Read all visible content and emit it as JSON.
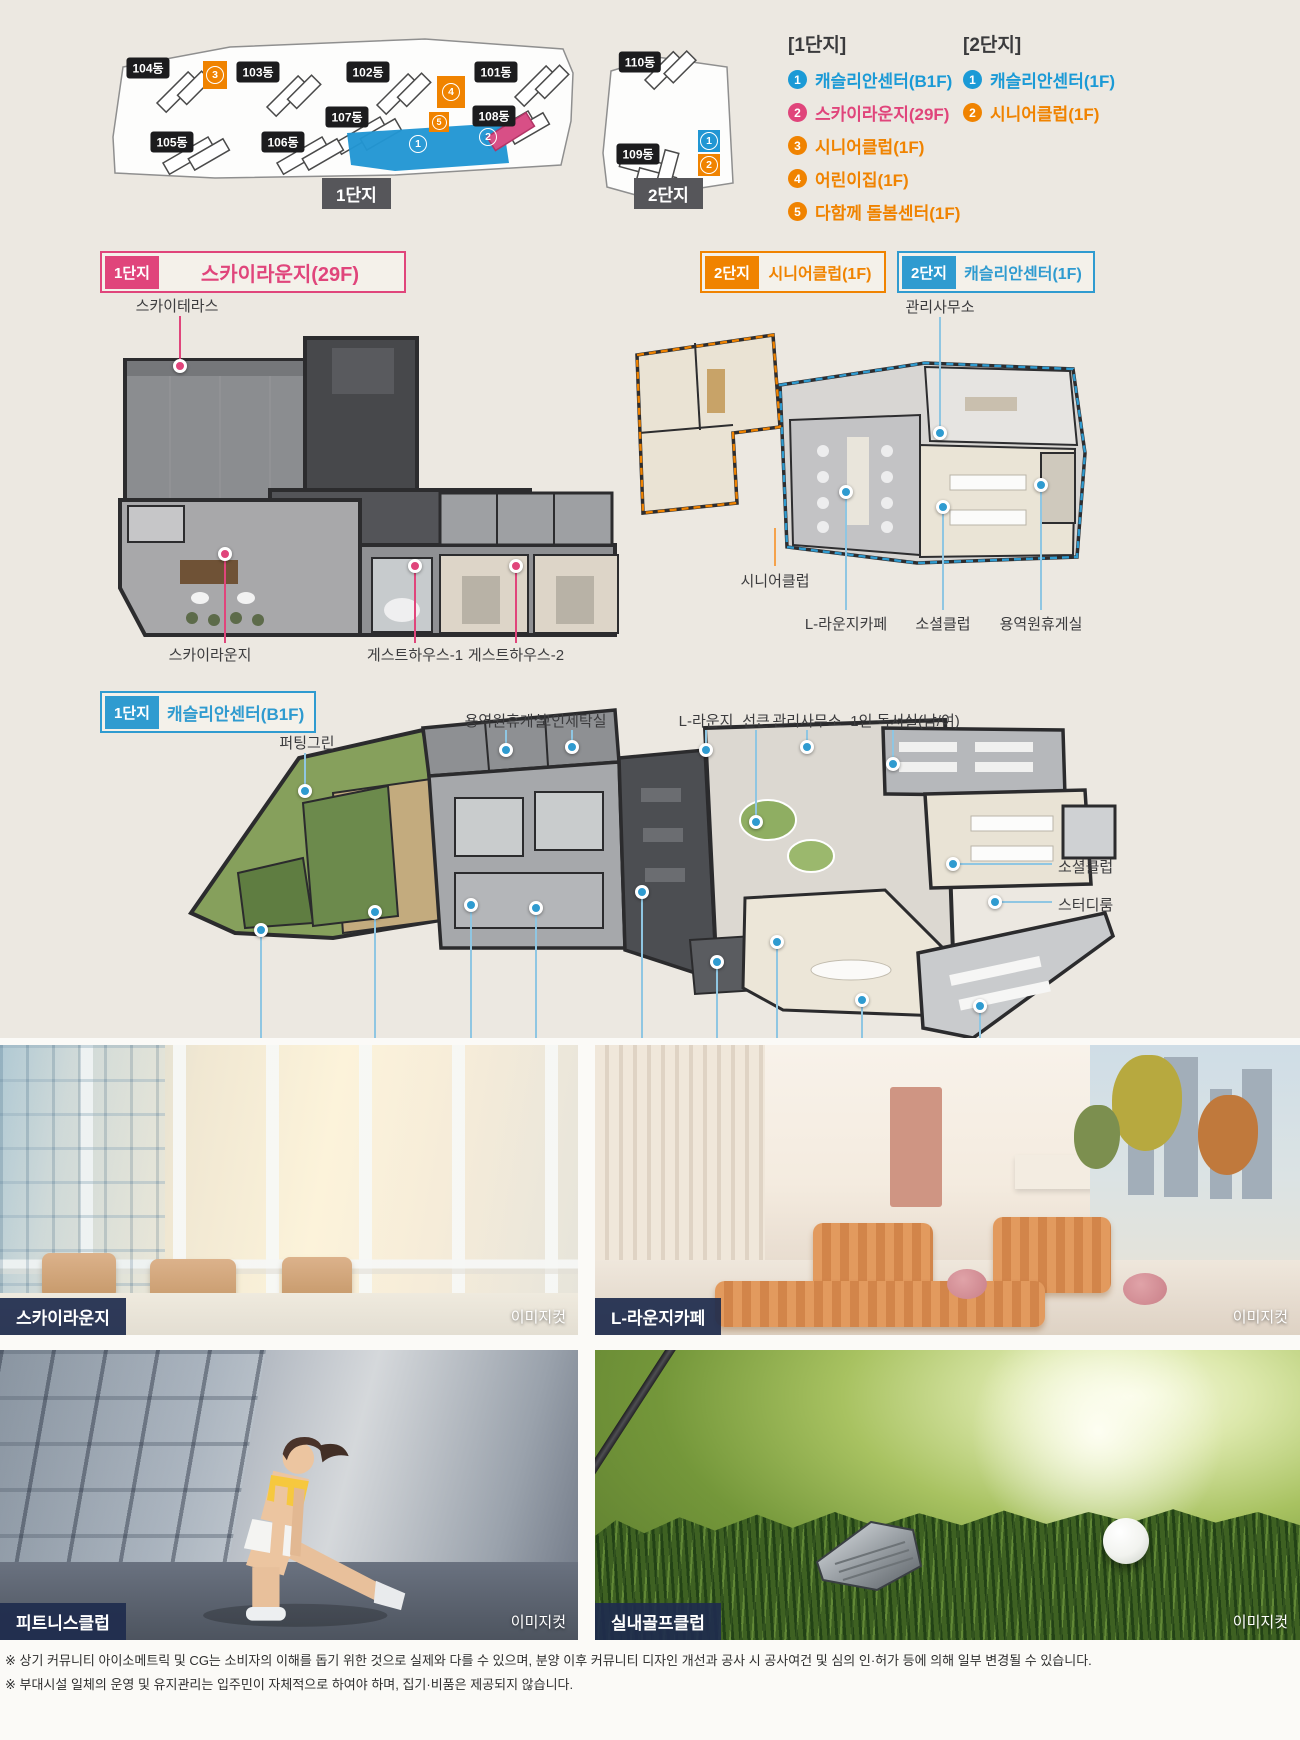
{
  "site": {
    "complex1": {
      "name": "1단지",
      "buildings": [
        {
          "label": "104동"
        },
        {
          "label": "103동"
        },
        {
          "label": "102동"
        },
        {
          "label": "101동"
        },
        {
          "label": "107동"
        },
        {
          "label": "108동"
        },
        {
          "label": "105동"
        },
        {
          "label": "106동"
        }
      ],
      "markers": [
        {
          "num": "3"
        },
        {
          "num": "4"
        },
        {
          "num": "5"
        },
        {
          "num": "1"
        },
        {
          "num": "2"
        }
      ]
    },
    "complex2": {
      "name": "2단지",
      "buildings": [
        {
          "label": "110동"
        },
        {
          "label": "109동"
        }
      ],
      "markers": [
        {
          "num": "1"
        },
        {
          "num": "2"
        }
      ]
    }
  },
  "legends": {
    "c1": {
      "title": "[1단지]",
      "items": [
        {
          "num": "1",
          "label": "캐슬리안센터(B1F)",
          "color": "#1b9ad6"
        },
        {
          "num": "2",
          "label": "스카이라운지(29F)",
          "color": "#e0457b"
        },
        {
          "num": "3",
          "label": "시니어클럽(1F)",
          "color": "#f08300"
        },
        {
          "num": "4",
          "label": "어린이집(1F)",
          "color": "#f08300"
        },
        {
          "num": "5",
          "label": "다함께 돌봄센터(1F)",
          "color": "#f08300"
        }
      ]
    },
    "c2": {
      "title": "[2단지]",
      "items": [
        {
          "num": "1",
          "label": "캐슬리안센터(1F)",
          "color": "#1b9ad6"
        },
        {
          "num": "2",
          "label": "시니어클럽(1F)",
          "color": "#f08300"
        }
      ]
    }
  },
  "plans": {
    "sky": {
      "badge": "1단지",
      "title": "스카이라운지(29F)",
      "terrace": "스카이테라스",
      "lounge": "스카이라운지",
      "guest1": "게스트하우스-1",
      "guest2": "게스트하우스-2"
    },
    "senior": {
      "badge": "2단지",
      "title": "시니어클럽(1F)",
      "club": "시니어클럽"
    },
    "cast2": {
      "badge": "2단지",
      "title": "캐슬리안센터(1F)",
      "office": "관리사무소",
      "cafe": "L-라운지카페",
      "social": "소셜클럽",
      "rest": "용역원휴게실"
    },
    "b1": {
      "badge": "1단지",
      "title": "캐슬리안센터(B1F)",
      "rest": "용역원휴게실",
      "laundry": "코인세탁실",
      "llounge": "L-라운지",
      "sunken": "선큰",
      "office": "관리사무소",
      "study_single": "1인 독서실(남/여)",
      "putting": "퍼팅그린",
      "social": "소셜클럽",
      "study": "스터디룸",
      "screen_golf": "스크린골프",
      "golf_club": "실내골프클럽",
      "sauna_m": "사우나(남)",
      "sauna_f": "사우나(여)",
      "fitness": "피트니스클럽",
      "gx": "GX룸",
      "kids": "키즈룸",
      "book_cafe": "북카페",
      "reading": "독서실"
    }
  },
  "photos": [
    {
      "caption": "스카이라운지",
      "tag": "이미지컷"
    },
    {
      "caption": "L-라운지카페",
      "tag": "이미지컷"
    },
    {
      "caption": "피트니스클럽",
      "tag": "이미지컷"
    },
    {
      "caption": "실내골프클럽",
      "tag": "이미지컷"
    }
  ],
  "disclaimer": {
    "line1": "※ 상기 커뮤니티 아이소메트릭 및 CG는 소비자의 이해를 돕기 위한 것으로 실제와 다를 수 있으며, 분양 이후 커뮤니티 디자인 개선과 공사 시 공사여건 및 심의 인·허가 등에 의해 일부 변경될 수 있습니다.",
    "line2": "※ 부대시설 일체의 운영 및 유지관리는 입주민이 자체적으로 하여야 하며, 집기·비품은 제공되지 않습니다."
  },
  "colors": {
    "accent_blue": "#1b9ad6",
    "accent_pink": "#e0457b",
    "accent_orange": "#f08300",
    "caption_navy": "#1f2c4d"
  }
}
